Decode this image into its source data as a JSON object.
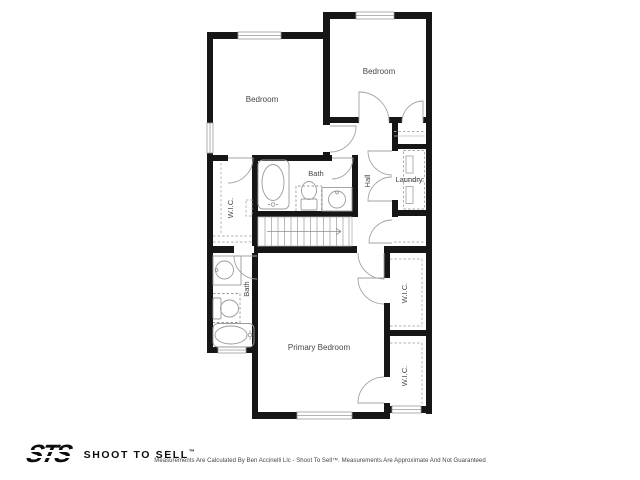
{
  "rooms": {
    "bedroom_left": "Bedroom",
    "bedroom_top_right": "Bedroom",
    "bath_upper": "Bath",
    "wic_left": "W.I.C.",
    "hall": "Hall",
    "laundry": "Laundry",
    "bath_lower": "Bath",
    "primary_bedroom": "Primary Bedroom",
    "wic_right_1": "W.I.C.",
    "wic_right_2": "W.I.C."
  },
  "footer": {
    "logo_text": "STS",
    "brand": "SHOOT TO SELL",
    "trademark": "™",
    "disclaimer": "Measurements Are Calculated By Ben Accinelli Llc - Shoot To Sell™. Measurements Are Approximate And Not Guaranteed"
  },
  "colors": {
    "wall": "#161616",
    "fixture_line": "#9b9b9b",
    "label": "#474747",
    "background": "#ffffff"
  }
}
